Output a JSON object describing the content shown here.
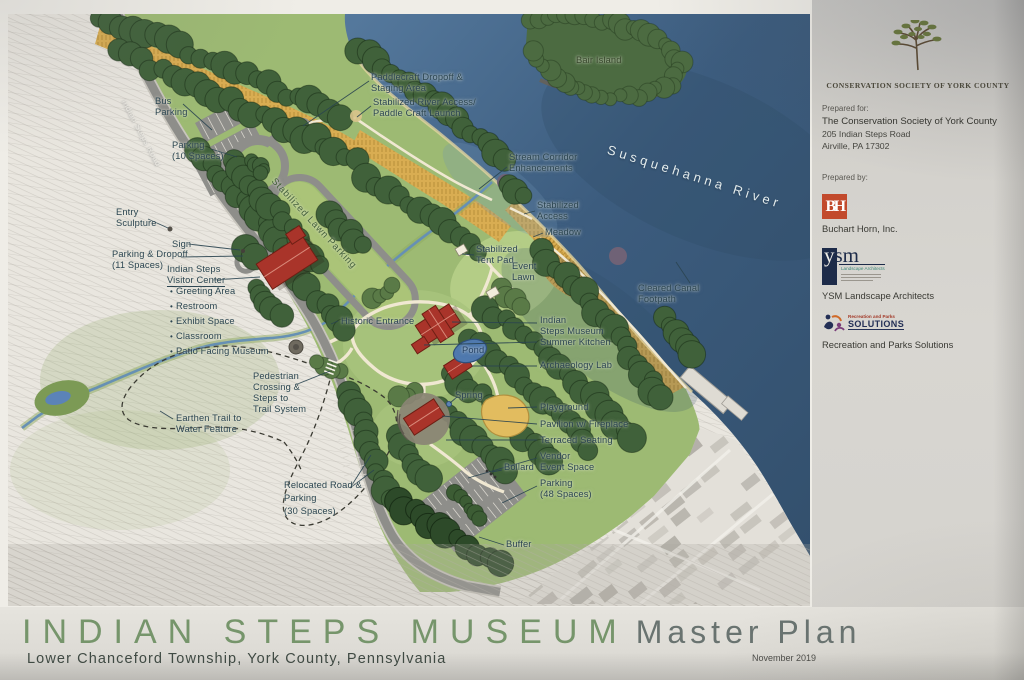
{
  "title_block": {
    "title": "INDIAN STEPS MUSEUM",
    "master_plan": "Master Plan",
    "location": "Lower Chanceford Township, York County, Pennsylvania",
    "date": "November 2019"
  },
  "panel": {
    "org_name": "CONSERVATION SOCIETY OF YORK COUNTY",
    "prepared_for_label": "Prepared for:",
    "prepared_for": [
      "The Conservation Society of York County",
      "205 Indian Steps Road",
      "Airville, PA 17302"
    ],
    "prepared_by_label": "Prepared by:",
    "firms": [
      {
        "logo_text": "BH",
        "name": "Buchart Horn, Inc."
      },
      {
        "logo_text": "ysm",
        "logo_sub": "Landscape Architects",
        "name": "YSM Landscape Architects"
      },
      {
        "logo_top": "Recreation and Parks",
        "logo_text": "SOLUTIONS",
        "name": "Recreation and Parks Solutions"
      }
    ]
  },
  "scale": {
    "label": "Scale: 1\" = 50'",
    "ticks": [
      "0'",
      "50'",
      "100'",
      "150'",
      "200'"
    ]
  },
  "north_label": "NORTH",
  "colors": {
    "river": "#3c5c7e",
    "forest": "#40613a",
    "lawn": "#9dba73",
    "meadow": "#d9ad52",
    "road": "#8e8e8a",
    "building": "#a9342a",
    "title_green": "#76956b",
    "bh_orange": "#c24a2c",
    "ysm_navy": "#1d2b49"
  },
  "map": {
    "labels": [
      {
        "id": "bus-parking",
        "x": 155,
        "y": 96,
        "lines": [
          "Bus",
          "Parking"
        ]
      },
      {
        "id": "parking-10-spaces",
        "x": 172,
        "y": 140,
        "lines": [
          "Parking",
          "(10 Spaces)"
        ]
      },
      {
        "id": "entry-sculpture",
        "x": 116,
        "y": 207,
        "lines": [
          "Entry",
          "Sculpture"
        ]
      },
      {
        "id": "sign",
        "x": 172,
        "y": 239,
        "lines": [
          "Sign"
        ]
      },
      {
        "id": "parking-dropoff-11",
        "x": 112,
        "y": 249,
        "lines": [
          "Parking & Dropoff",
          "(11 Spaces)"
        ]
      },
      {
        "id": "visitor-center",
        "x": 167,
        "y": 264,
        "lines": [
          "Indian Steps",
          "Visitor Center"
        ],
        "underline": 1
      },
      {
        "id": "visitor-center-list",
        "x": 170,
        "y": 284,
        "bullets": true,
        "lh": 14,
        "lines": [
          "Greeting Area",
          "Restroom",
          "Exhibit Space",
          "Classroom",
          "Patio Facing Museum"
        ]
      },
      {
        "id": "pedestrian-crossing",
        "x": 253,
        "y": 371,
        "lines": [
          "Pedestrian",
          "Crossing &",
          "Steps to",
          "Trail System"
        ]
      },
      {
        "id": "earthen-trail",
        "x": 176,
        "y": 413,
        "lines": [
          "Earthen Trail to",
          "Water Feature"
        ]
      },
      {
        "id": "relocated-road",
        "x": 284,
        "y": 479,
        "lh": 13,
        "lines": [
          "Relocated Road &",
          "Parking",
          "(30 Spaces)"
        ]
      },
      {
        "id": "historic-entrance",
        "x": 341,
        "y": 316,
        "lines": [
          "Historic Entrance"
        ]
      },
      {
        "id": "indian-steps-museum",
        "x": 540,
        "y": 315,
        "lines": [
          "Indian",
          "Steps Museum"
        ]
      },
      {
        "id": "summer-kitchen",
        "x": 540,
        "y": 337,
        "lines": [
          "Summer Kitchen"
        ]
      },
      {
        "id": "archaeology-lab",
        "x": 540,
        "y": 360,
        "lines": [
          "Archaeology Lab"
        ]
      },
      {
        "id": "pond",
        "x": 462,
        "y": 345,
        "lines": [
          "Pond"
        ],
        "color": "#223f63"
      },
      {
        "id": "spring",
        "x": 455,
        "y": 390,
        "lines": [
          "Spring"
        ]
      },
      {
        "id": "playground",
        "x": 540,
        "y": 402,
        "lines": [
          "Playground"
        ]
      },
      {
        "id": "pavilion-fireplace",
        "x": 540,
        "y": 419,
        "lines": [
          "Pavilion w/ Fireplace"
        ]
      },
      {
        "id": "terraced-seating",
        "x": 540,
        "y": 435,
        "lines": [
          "Terraced Seating"
        ]
      },
      {
        "id": "vendor-event-space",
        "x": 540,
        "y": 451,
        "lines": [
          "Vendor",
          "Event Space"
        ]
      },
      {
        "id": "bollard",
        "x": 504,
        "y": 462,
        "lines": [
          "Bollard"
        ]
      },
      {
        "id": "parking-48-spaces",
        "x": 540,
        "y": 478,
        "lines": [
          "Parking",
          "(48 Spaces)"
        ]
      },
      {
        "id": "buffer",
        "x": 506,
        "y": 539,
        "lines": [
          "Buffer"
        ]
      },
      {
        "id": "paddlecraft-dropoff",
        "x": 371,
        "y": 72,
        "lines": [
          "Paddlecraft Dropoff &",
          "Staging Area"
        ]
      },
      {
        "id": "river-access",
        "x": 373,
        "y": 97,
        "lines": [
          "Stabilized River Access/",
          "Paddle Craft Launch"
        ]
      },
      {
        "id": "stream-corridor",
        "x": 509,
        "y": 152,
        "lines": [
          "Stream Corridor",
          "Enhancements"
        ]
      },
      {
        "id": "stabilized-access",
        "x": 537,
        "y": 200,
        "lines": [
          "Stabilized",
          "Access"
        ]
      },
      {
        "id": "meadow",
        "x": 545,
        "y": 227,
        "lines": [
          "Meadow"
        ]
      },
      {
        "id": "stabilized-tent-pad",
        "x": 476,
        "y": 244,
        "lines": [
          "Stabilized",
          "Tent Pad"
        ]
      },
      {
        "id": "event-lawn",
        "x": 512,
        "y": 261,
        "lines": [
          "Event",
          "Lawn"
        ]
      },
      {
        "id": "cleared-canal-footpath",
        "x": 638,
        "y": 283,
        "lines": [
          "Cleared Canal",
          "Footpath"
        ]
      },
      {
        "id": "bair-island",
        "x": 576,
        "y": 55,
        "lines": [
          "Bair Island"
        ],
        "color": "#37462b"
      },
      {
        "id": "susquehanna-river",
        "x": 610,
        "y": 142,
        "lines": [
          "Susquehanna River"
        ],
        "color": "#e3ebec",
        "size": 13,
        "ls": 4,
        "rot": 17.5,
        "shadow": "none"
      },
      {
        "id": "stabilized-lawn-parking",
        "x": 277,
        "y": 176,
        "lines": [
          "Stabilized Lawn Parking"
        ],
        "color": "#44603b",
        "size": 9.5,
        "ls": 0.8,
        "rot": 47
      },
      {
        "id": "indian-steps-road",
        "x": 128,
        "y": 98,
        "lines": [
          "Indian Steps Road"
        ],
        "color": "#ebe9e2",
        "size": 8,
        "ls": 0.5,
        "rot": 62,
        "shadow": "none"
      }
    ]
  }
}
